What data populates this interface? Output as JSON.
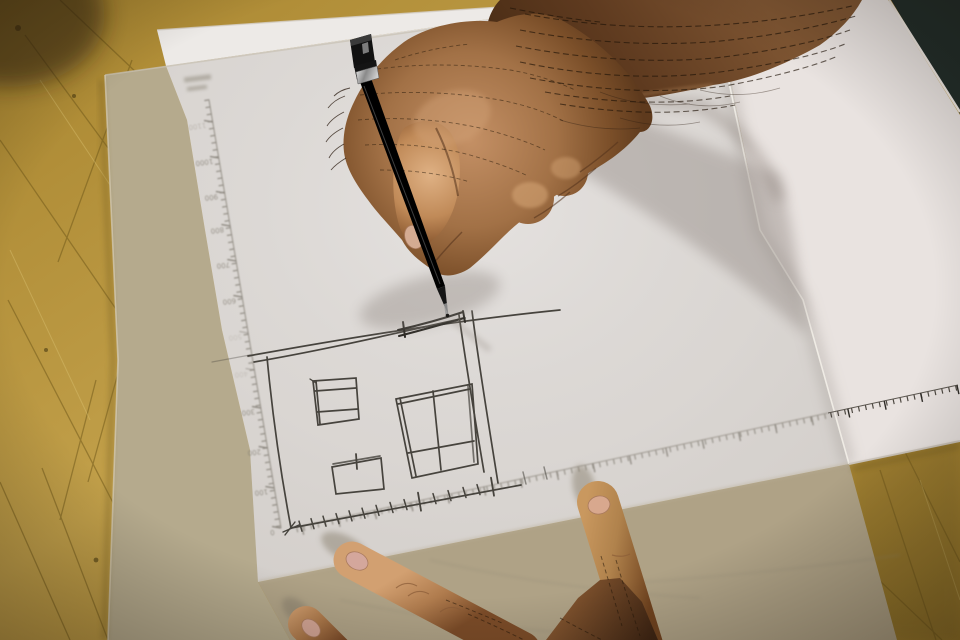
{
  "rulers": {
    "vertical_axis": {
      "labels": [
        "1100",
        "1000",
        "900",
        "800",
        "700",
        "600",
        "500",
        "400",
        "300",
        "200",
        "100",
        "0"
      ]
    },
    "horizontal_axis": {
      "labels": []
    }
  },
  "colors": {
    "wood": "#b6923d",
    "dark_corner": "#232e2a",
    "tracing_over_wood": "#b5aa8d",
    "tracing_over_wood_bottom": "#afa286",
    "sheet_under_tracing": "#d8d4d0",
    "sheet_exposed": "#e9e3e0",
    "sheet_corner_band": "#edeae7",
    "printed_ruler": "#7c766b",
    "sketch_ink": "#46433d",
    "pen_body": "#161616",
    "skin_light": "#cf9c6c",
    "skin_dark": "#6e4425"
  }
}
